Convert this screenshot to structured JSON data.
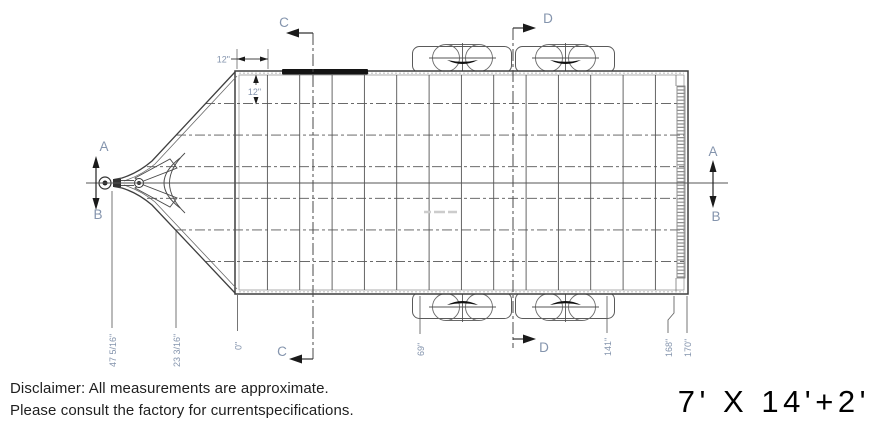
{
  "drawing": {
    "section_markers": {
      "a": "A",
      "b": "B",
      "c": "C",
      "d": "D"
    },
    "dimensions": {
      "rail_setback": "12\"",
      "crossmember_spacing": "12\"",
      "bottom_labels": [
        "47 5/16\"",
        "23 3/16\"",
        "0\"",
        "69\"",
        "141\"",
        "168\"",
        "170\""
      ]
    },
    "colors": {
      "line": "#3f3f3f",
      "grid": "#555555",
      "dim_text": "#8494ad",
      "arrow": "#1a1a1a",
      "hatch": "#8f8f8f"
    }
  },
  "footer": {
    "disclaimer_line1": "Disclaimer: All measurements are approximate.",
    "disclaimer_line2": "Please consult the factory for currentspecifications.",
    "size_label": "7' X 14'+2'"
  }
}
